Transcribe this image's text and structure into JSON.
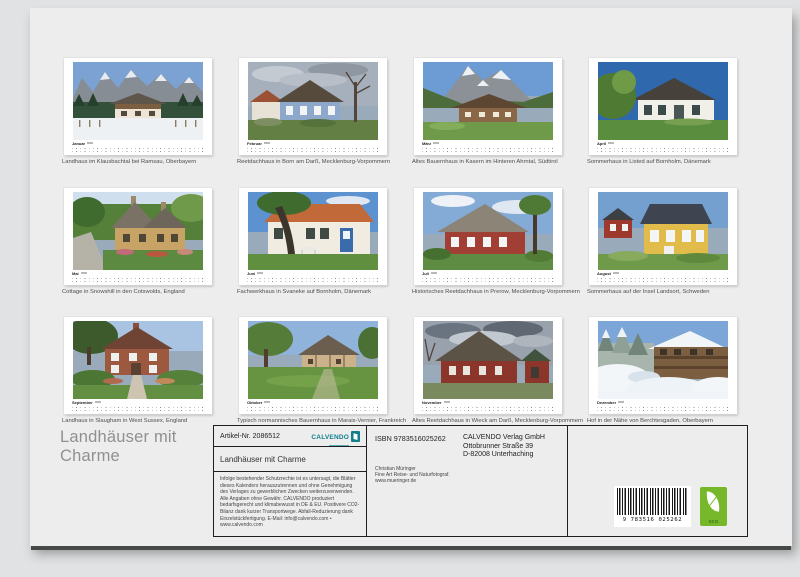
{
  "sheet_title": "Landhäuser mit Charme",
  "thumbnails": [
    {
      "month": "Januar",
      "caption": "Landhaus im Klausbachtal bei Ramsau, Oberbayern"
    },
    {
      "month": "Februar",
      "caption": "Reetdachhaus in Born am Darß, Mecklenburg-Vorpommern"
    },
    {
      "month": "März",
      "caption": "Altes Bauernhaus in Kasern im Hinteren Ahrntal, Südtirol"
    },
    {
      "month": "April",
      "caption": "Sommerhaus in Listed auf Bornholm, Dänemark"
    },
    {
      "month": "Mai",
      "caption": "Cottage in Snowshill in den Cotswolds, England"
    },
    {
      "month": "Juni",
      "caption": "Fachwerkhaus in Svaneke auf Bornholm, Dänemark"
    },
    {
      "month": "Juli",
      "caption": "Historisches Reetdachhaus in Prerow, Mecklenburg-Vorpommern"
    },
    {
      "month": "August",
      "caption": "Sommerhaus auf der Insel Landsort, Schweden"
    },
    {
      "month": "September",
      "caption": "Landhaus in Slaugham in West Sussex, England"
    },
    {
      "month": "Oktober",
      "caption": "Typisch normannisches Bauernhaus in Marais-Vernier, Frankreich"
    },
    {
      "month": "November",
      "caption": "Altes Reetdachhaus in Wieck am Darß, Mecklenburg-Vorpommern"
    },
    {
      "month": "Dezember",
      "caption": "Hof in der Nähe von Berchtesgaden, Oberbayern"
    }
  ],
  "info_box": {
    "article_label": "Artikel-Nr. 2086512",
    "brand": "CALVENDO",
    "product_title": "Landhäuser mit Charme",
    "legal": "Infolge bestehender Schutzrechte ist es untersagt, die Blätter dieses Kalenders herauszutrennen und ohne Genehmigung des Verlages zu gewerblichen Zwecken weiterzuverwenden. Alle Angaben ohne Gewähr. CALVENDO produziert bedarfsgerecht und klimabewusst in DE & EU. Positivere CO2-Bilanz dank kurzer Transportwege. Abfall-Reduzierung dank Einzelstückfertigung. E-Mail: info@calvendo.com • www.calvendo.com",
    "isbn": "ISBN 9783516025262",
    "publisher": [
      "CALVENDO Verlag GmbH",
      "Ottobrunner Straße 39",
      "D-82008 Unterhaching"
    ],
    "photographer": [
      "Christian Müringer",
      "Fine Art Reise- und Naturfotograf.",
      "www.mueringer.de"
    ],
    "barcode_digits": "9 783516 025262",
    "eco_label": "eco"
  },
  "colors": {
    "brand_teal": "#12808a",
    "eco_green": "#76b82a"
  }
}
